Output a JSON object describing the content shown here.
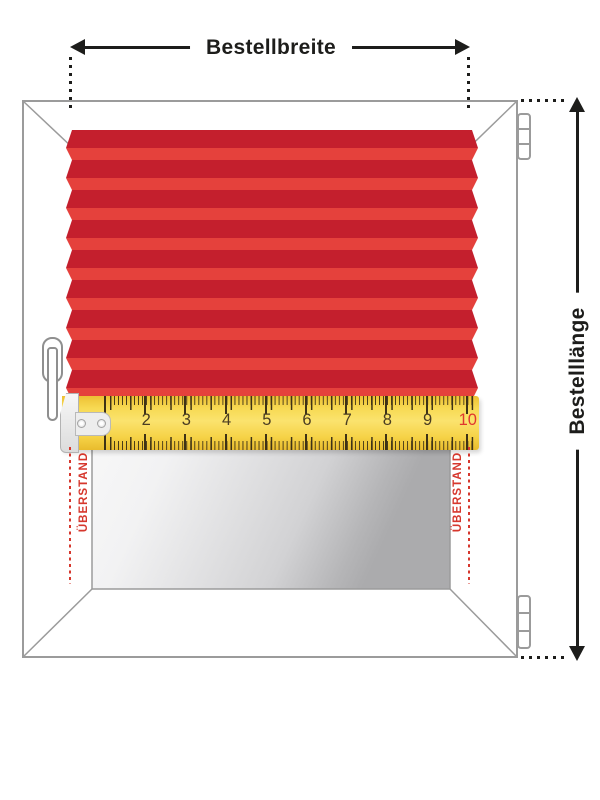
{
  "annotations": {
    "width_label": "Bestellbreite",
    "length_label": "Bestelllänge",
    "overhang_left_label": "ÜBERSTAND",
    "overhang_right_label": "ÜBERSTAND",
    "ink_color": "#1d1d1b",
    "overhang_color": "#d6372d"
  },
  "window": {
    "frame_color": "#9b9b9b",
    "glass_top_color": "#ffffff",
    "glass_bottom_color": "#ababad"
  },
  "blind": {
    "pleat_count": 9,
    "dark_color": "#c41f2d",
    "light_color": "#e5413c"
  },
  "ruler": {
    "numbers": [
      "1",
      "2",
      "3",
      "4",
      "5",
      "6",
      "7",
      "8",
      "9",
      "10"
    ],
    "tick_color": "#3e3216",
    "number_color": "#4a3d22",
    "last_number_color": "#e0372e",
    "tape_color": "#f6d14a"
  }
}
